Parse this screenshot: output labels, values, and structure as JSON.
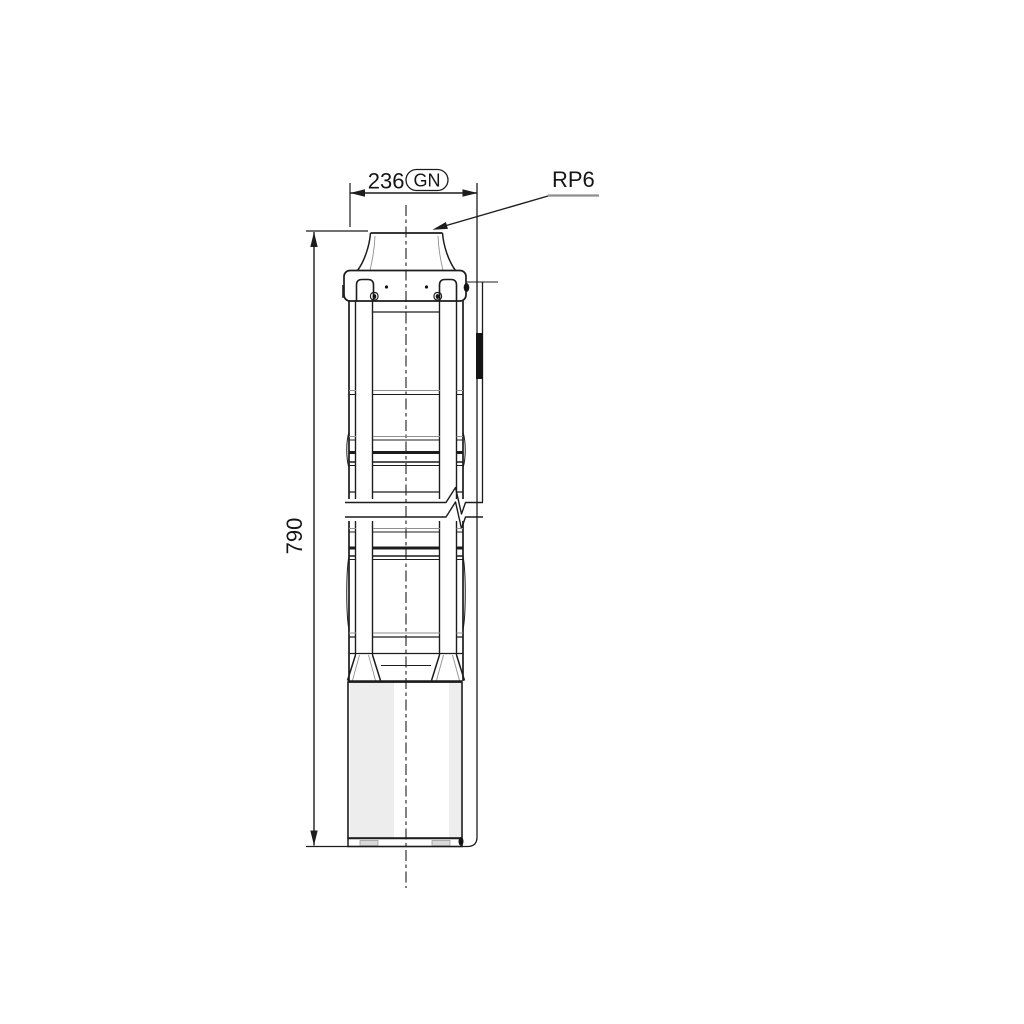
{
  "drawing": {
    "labels": {
      "width_value": "236",
      "width_badge": "GN",
      "connection_label": "RP6",
      "height_value": "790"
    },
    "colors": {
      "line": "#1c1c1c",
      "soft_line": "#8f8f8f",
      "background": "#ffffff"
    }
  }
}
